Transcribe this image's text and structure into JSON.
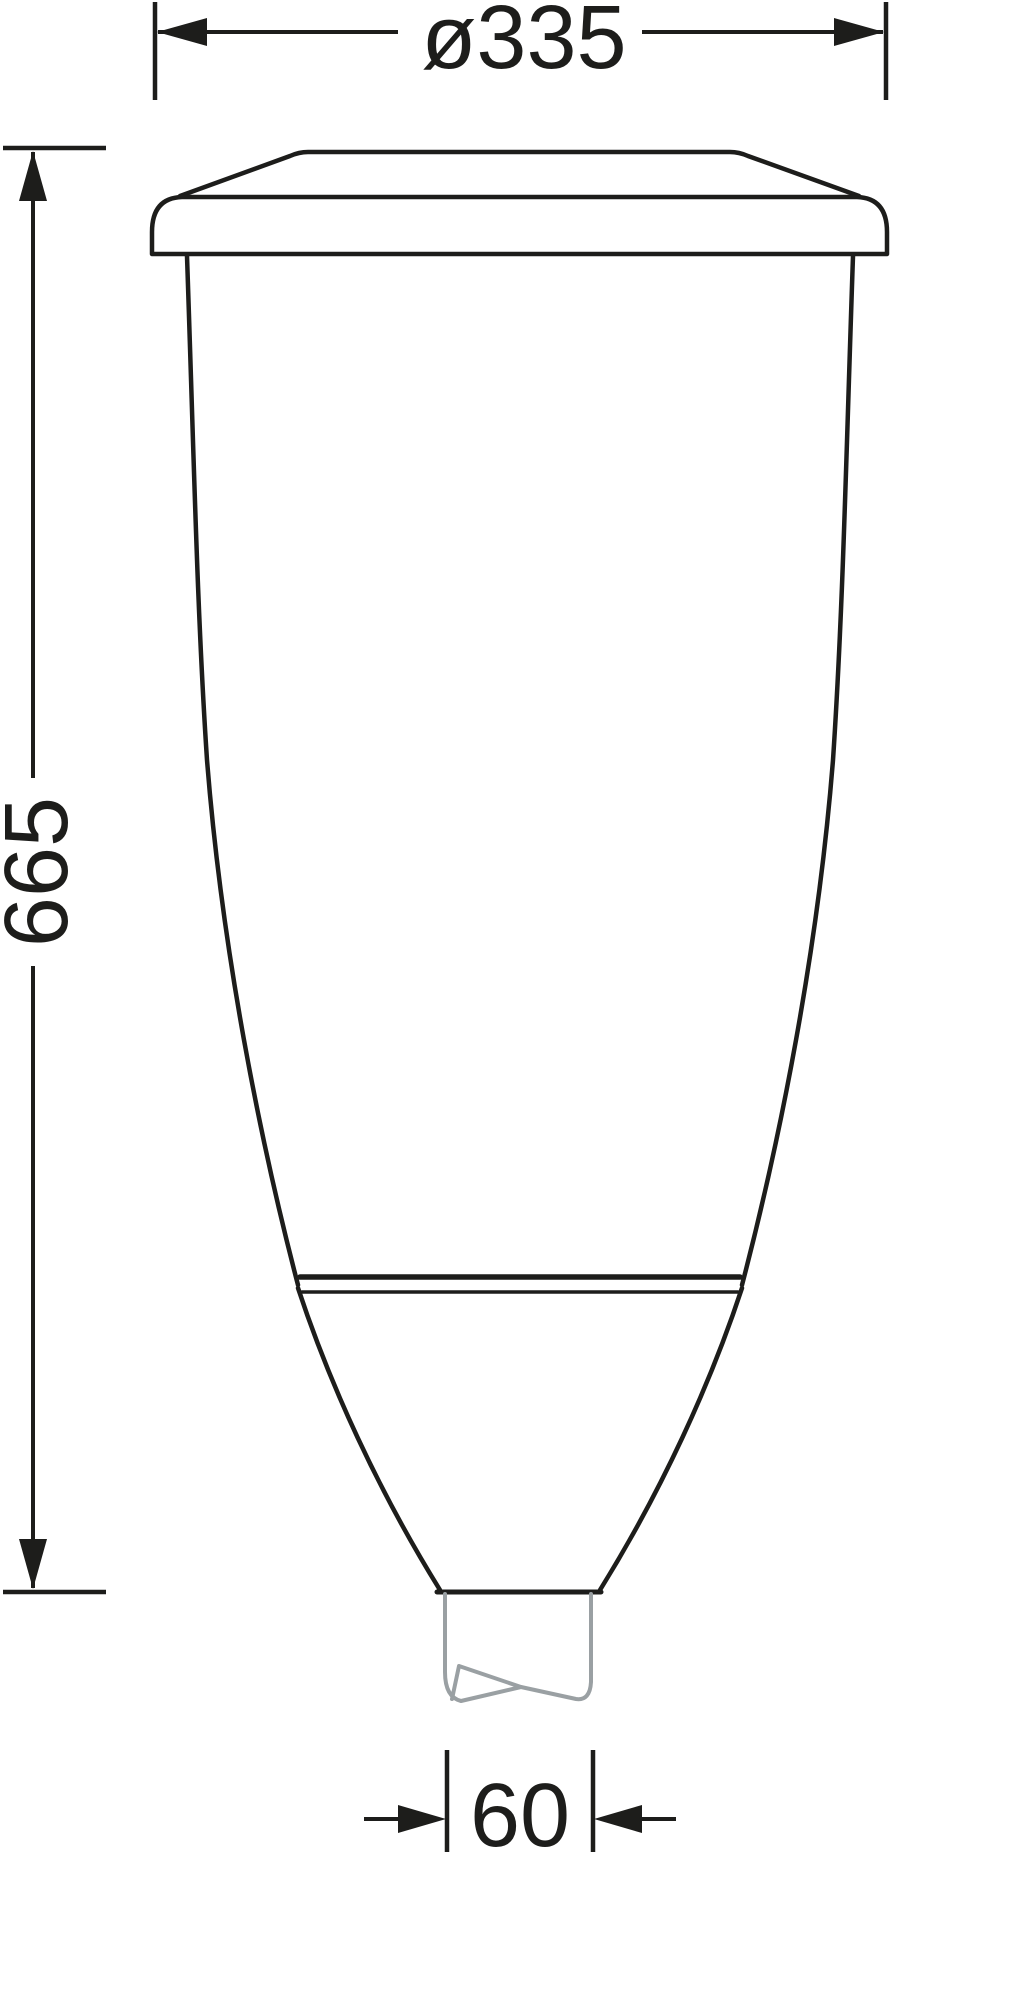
{
  "drawing": {
    "title": "Technical dimension drawing of tapered luminaire with pole spigot",
    "labels": {
      "diameter": "ø335",
      "height": "665",
      "spigot_width": "60"
    },
    "values": {
      "diameter_mm": 335,
      "height_mm": 665,
      "spigot_width_mm": 60
    },
    "colors": {
      "ink": "#1d1d1b",
      "spigot": "#9aa0a3",
      "background": "#ffffff"
    }
  }
}
